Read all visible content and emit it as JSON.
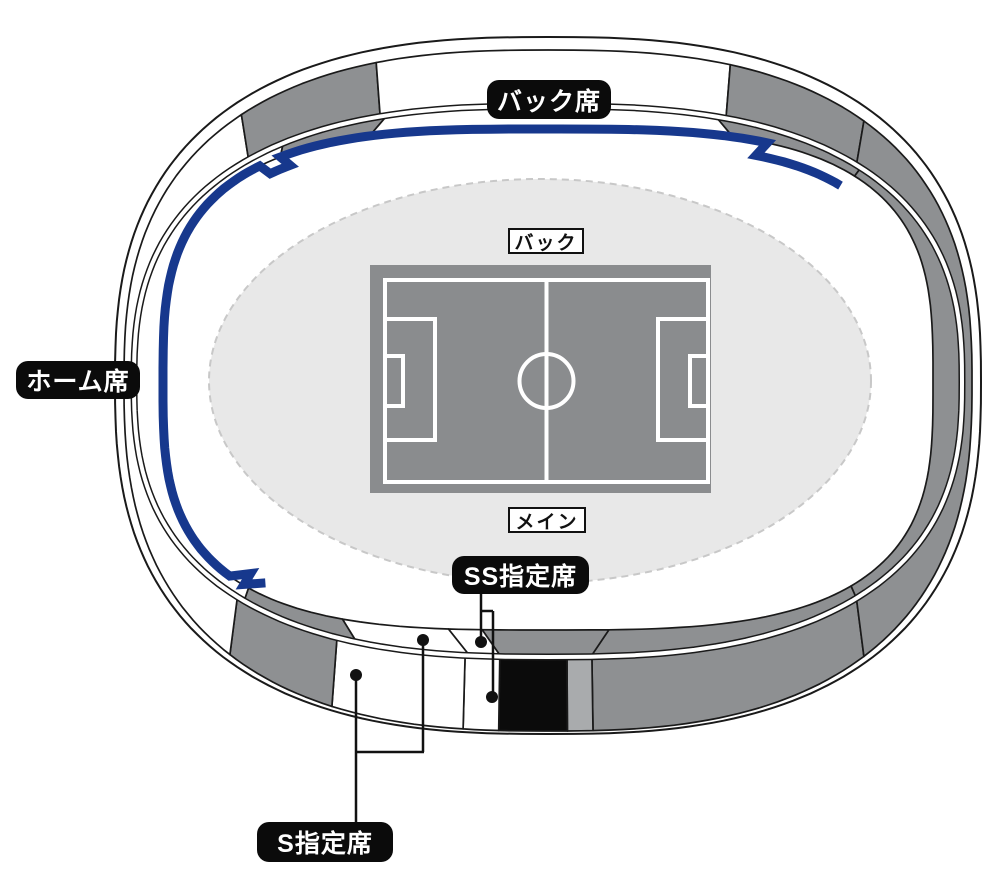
{
  "labels": {
    "back_stand": "バック席",
    "home_stand": "ホーム席",
    "ss_seat": "SS指定席",
    "s_seat": "S指定席",
    "pitch_back": "バック",
    "pitch_main": "メイン"
  },
  "colors": {
    "home_line": "#17388d",
    "gray": "#8e9092",
    "gray_light": "#a9abad",
    "black": "#0b0b0b",
    "white": "#ffffff",
    "outline": "#1a1a1a",
    "field_bg": "#e8e8e8",
    "field_border": "#c8c8c8",
    "pitch_gray": "#8a8c8e",
    "pitch_line": "#ffffff",
    "label_bg": "#0b0b0b",
    "label_fg": "#ffffff"
  },
  "outer_band_sections": [
    {
      "from": 47,
      "to": 86.9,
      "color": "gray",
      "name": "outer-bottom-right-gray",
      "interactable": false
    },
    {
      "from": 86.9,
      "to": 88.96,
      "color": "gray_light",
      "name": "outer-bottom-light-gray",
      "interactable": false
    },
    {
      "from": 88.96,
      "to": 93.5,
      "color": "black",
      "name": "outer-bottom-black",
      "interactable": false
    },
    {
      "from": 93.5,
      "to": 97.1,
      "color": "white",
      "name": "ss-reserved-outer",
      "interactable": true
    },
    {
      "from": 97.1,
      "to": 114.6,
      "color": "white",
      "name": "s-reserved-outer",
      "interactable": true
    },
    {
      "from": 114.6,
      "to": 133.5,
      "color": "gray",
      "name": "outer-bottom-left-gray",
      "interactable": false
    },
    {
      "from": 133.5,
      "to": 229,
      "color": "white",
      "name": "home-stand-outer",
      "interactable": true
    },
    {
      "from": 229,
      "to": 252,
      "color": "gray",
      "name": "outer-top-left-gray",
      "interactable": false
    },
    {
      "from": 252,
      "to": 289.5,
      "color": "white",
      "name": "back-stand-outer",
      "interactable": true
    },
    {
      "from": 289.5,
      "to": 313,
      "color": "gray",
      "name": "outer-top-right-gray",
      "interactable": false
    },
    {
      "from": 313,
      "to": 407,
      "color": "gray",
      "name": "outer-right-gray",
      "interactable": false
    }
  ],
  "inner_band_sections": [
    {
      "from": 47,
      "to": 87,
      "color": "gray",
      "name": "inner-bottom-right-gray",
      "interactable": false
    },
    {
      "from": 87,
      "to": 93.4,
      "color": "gray",
      "name": "inner-bottom-center-gray",
      "interactable": false
    },
    {
      "from": 93.4,
      "to": 96.6,
      "color": "white",
      "name": "ss-reserved-inner",
      "interactable": true
    },
    {
      "from": 96.6,
      "to": 111.5,
      "color": "white",
      "name": "s-reserved-inner",
      "interactable": true
    },
    {
      "from": 111.5,
      "to": 132,
      "color": "gray",
      "name": "inner-bottom-left-gray",
      "interactable": false
    },
    {
      "from": 132,
      "to": 236,
      "color": "white",
      "name": "home-stand-inner",
      "interactable": true
    },
    {
      "from": 236,
      "to": 253,
      "color": "gray",
      "name": "inner-top-left-gray",
      "interactable": false
    },
    {
      "from": 253,
      "to": 288,
      "color": "white",
      "name": "back-stand-inner",
      "interactable": true
    },
    {
      "from": 288,
      "to": 314,
      "color": "gray",
      "name": "inner-top-right-gray",
      "interactable": false
    },
    {
      "from": 314,
      "to": 407,
      "color": "gray",
      "name": "inner-right-gray",
      "interactable": false
    }
  ],
  "home_line": {
    "start_deg": 314,
    "end_deg": 137.5,
    "name": "home-seats-boundary-line"
  }
}
